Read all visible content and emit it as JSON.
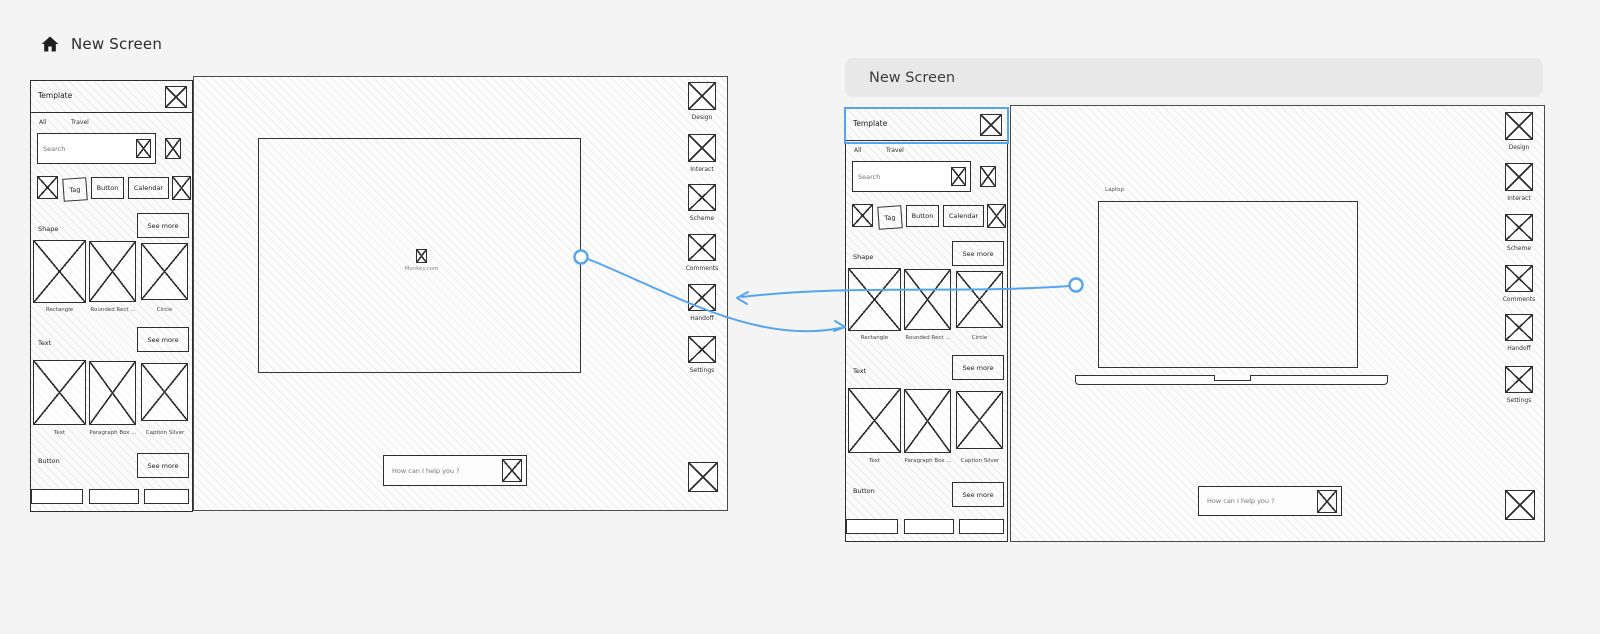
{
  "app": {
    "title": "New Screen"
  },
  "frame2": {
    "title": "New Screen"
  },
  "colors": {
    "accent": "#55a4ee",
    "stroke": "#2e2e2e",
    "background": "#f4f4f5"
  },
  "panel": {
    "title": "Template",
    "tabs": {
      "all": "All",
      "travel": "Travel"
    },
    "search": {
      "placeholder": "Search"
    },
    "chips": {
      "tag": "Tag",
      "button": "Button",
      "calendar": "Calendar"
    },
    "see_more": "See more",
    "shape": {
      "label": "Shape",
      "items": {
        "rectangle": "Rectangle",
        "rounded": "Rounded Rect ...",
        "circle": "Circle"
      }
    },
    "text": {
      "label": "Text",
      "items": {
        "text": "Text",
        "paragraph": "Paragraph Box ...",
        "caption": "Caption Silver"
      }
    },
    "button": {
      "label": "Button"
    }
  },
  "toolbar": {
    "design": "Design",
    "interact": "Interact",
    "scheme": "Scheme",
    "comments": "Comments",
    "handoff": "Handoff",
    "settings": "Settings"
  },
  "canvas": {
    "placeholder_caption": "Monkey.com",
    "laptop_label": "Laptop"
  },
  "chat": {
    "placeholder": "How can I help you ?"
  }
}
